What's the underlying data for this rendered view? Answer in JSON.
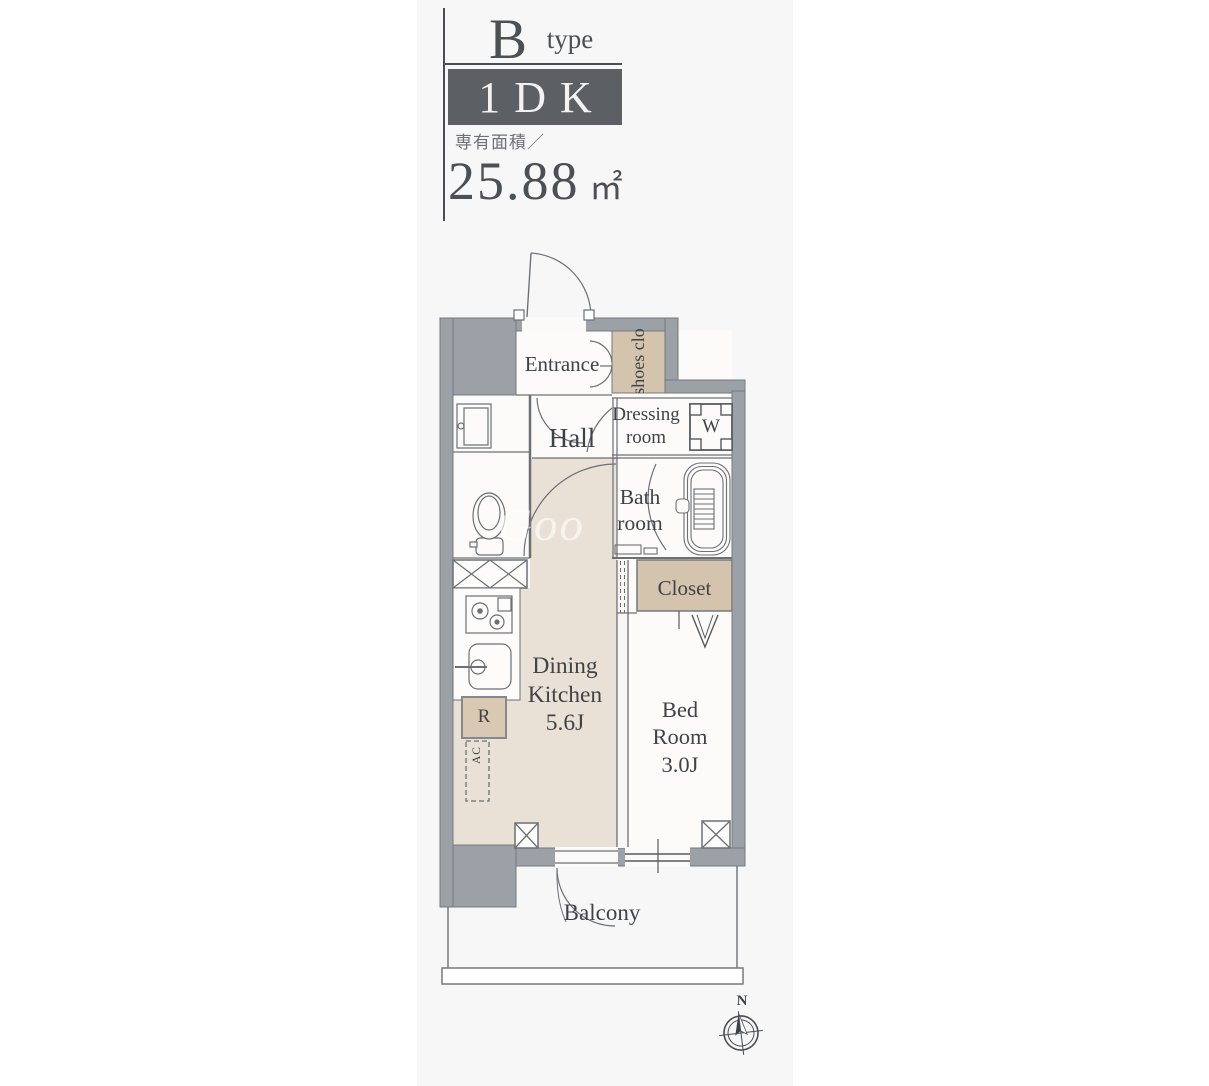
{
  "header": {
    "type_letter": "B",
    "type_word": "type",
    "layout": "1DK",
    "area_label": "専有面積／",
    "area_value": "25.88",
    "area_unit": "㎡"
  },
  "plan": {
    "rooms": {
      "entrance": "Entrance",
      "shoes_closet": "shoes clo",
      "hall": "Hall",
      "dressing": {
        "line1": "Dressing",
        "line2": "room"
      },
      "bath": {
        "line1": "Bath",
        "line2": "room"
      },
      "closet": "Closet",
      "dining_kitchen": {
        "line1": "Dining",
        "line2": "Kitchen",
        "size": "5.6J"
      },
      "bedroom": {
        "line1": "Bed",
        "line2": "Room",
        "size": "3.0J"
      },
      "balcony": "Balcony"
    },
    "fixtures": {
      "washing_machine": "W",
      "refrigerator": "R",
      "air_conditioner": "AC"
    },
    "compass": {
      "north": "N"
    },
    "watermark": "Goo"
  },
  "colors": {
    "wall_gray": "#9ba1a7",
    "floor_beige": "#e9e1d5",
    "closet_beige": "#d4c4ae",
    "accent_dark": "#5c6064",
    "text": "#3f4347",
    "panel_background": "#f8f7f7"
  }
}
